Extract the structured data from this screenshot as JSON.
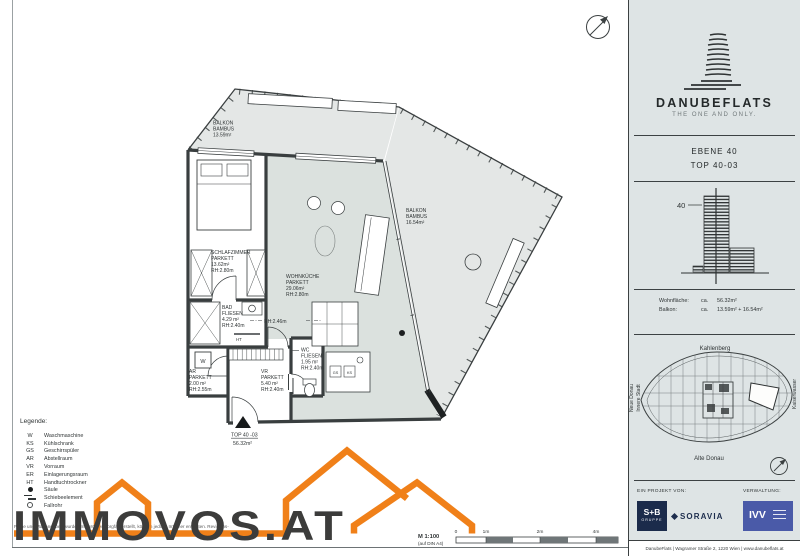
{
  "colors": {
    "accent_orange": "#F08019",
    "sidebar_bg": "#DEE4E5",
    "wall": "#3A3F40",
    "balcony_fill": "#E4E7E6",
    "livingroom_fill": "#DBE1DE",
    "navy": "#1B2B4B",
    "ivv_blue": "#4A5AA8"
  },
  "plan": {
    "rooms": {
      "balkon1": {
        "l1": "BALKON",
        "l2": "BAMBUS",
        "l3": "13.59m²"
      },
      "schlafzimmer": {
        "l1": "SCHLAFZIMMER",
        "l2": "PARKETT",
        "l3": "13.62m²",
        "l4": "RH:2.80m"
      },
      "wohnkueche": {
        "l1": "WOHNKÜCHE",
        "l2": "PARKETT",
        "l3": "29.06m²",
        "l4": "RH:2.80m"
      },
      "balkon2": {
        "l1": "BALKON",
        "l2": "BAMBUS",
        "l3": "16.54m²"
      },
      "bad": {
        "l1": "BAD",
        "l2": "FLIESEN",
        "l3": "4.29 m²",
        "l4": "RH:2.40m"
      },
      "ar": {
        "l1": "AR",
        "l2": "PARKETT",
        "l3": "2.00 m²",
        "l4": "RH:2.55m"
      },
      "vr": {
        "l1": "VR",
        "l2": "PARKETT",
        "l3": "5.40 m²",
        "l4": "RH:2.40m"
      },
      "wc": {
        "l1": "WC",
        "l2": "FLIESEN",
        "l3": "1.95 m²",
        "l4": "RH:2.40m"
      }
    },
    "notes": {
      "rh246": "RH:2.46m",
      "ht": "HT",
      "w": "W",
      "gs": "GS",
      "ks": "KS"
    },
    "unit": {
      "l1": "TOP 40 -03",
      "l2": "56.32m²"
    },
    "scale": {
      "label": "M 1:100",
      "sub": "(auf DIN A4)",
      "ticks": [
        "0",
        "1m",
        "2m",
        "4m"
      ]
    }
  },
  "legend": {
    "title": "Legende:",
    "items": [
      {
        "key": "W",
        "label": "Waschmaschine"
      },
      {
        "key": "KS",
        "label": "Kühlschrank"
      },
      {
        "key": "GS",
        "label": "Geschirrspüler"
      },
      {
        "key": "AR",
        "label": "Abstellraum"
      },
      {
        "key": "VR",
        "label": "Vorraum"
      },
      {
        "key": "ER",
        "label": "Einlagerungsraum"
      },
      {
        "key": "HT",
        "label": "Handtuchtrockner"
      },
      {
        "key": "",
        "label": "Säule"
      },
      {
        "key": "",
        "label": "Schiebeelement"
      },
      {
        "key": "",
        "label": "Fallrohr"
      }
    ]
  },
  "watermark": {
    "brand": "IMMOVOS.AT"
  },
  "disclaimer": {
    "line1": "Pläne und Maßangaben wurden mit größter Sorgfalt erstellt, können jedoch Irrtümer enthalten. Revisions-",
    "line2": "änderungen werden nach Baufertigstellung eingearbeitet. Für die Einrichtungsplanung sind Naturmaße erforderlich!"
  },
  "sidebar": {
    "brand": {
      "wordmark": "DANUBEFLATS",
      "tagline": "THE ONE AND ONLY."
    },
    "unit": {
      "ebene": "EBENE 40",
      "top": "TOP 40-03"
    },
    "elevation": {
      "floor": "40"
    },
    "areas": {
      "rows": [
        {
          "label": "Wohnfläche:",
          "approx": "ca.",
          "value": "56.32m²"
        },
        {
          "label": "Balkon:",
          "approx": "ca.",
          "value": "13.59m² + 16.54m²"
        }
      ]
    },
    "siteplan": {
      "north": "Kahlenberg",
      "west1": "Neue Donau",
      "west2": "Innere Stadt",
      "east": "Kaiserwasser",
      "south": "Alte Donau"
    },
    "footer": {
      "project": "EIN PROJEKT VON:",
      "mgmt": "VERWALTUNG:",
      "sb1": "S+B",
      "sb2": "GRUPPE",
      "soravia": "SORAVIA",
      "ivv": "IVV",
      "address": "DanubeFlats   |   Wagramer Straße 2, 1220 Wien   |   www.danubeflats.at"
    }
  }
}
